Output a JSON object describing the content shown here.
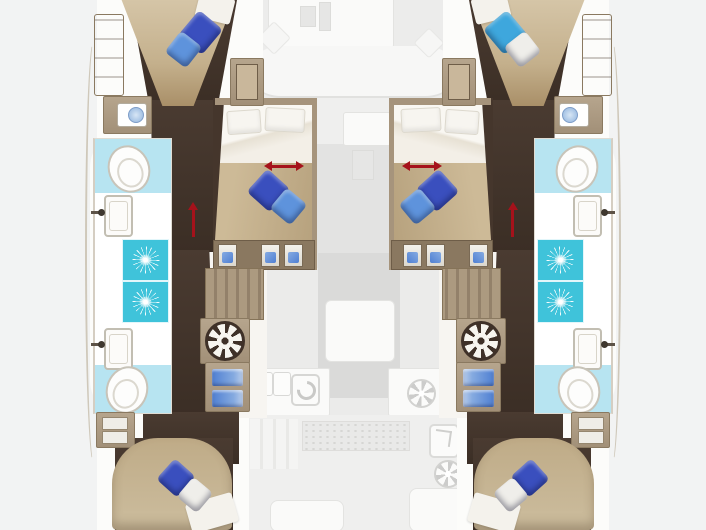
{
  "diagram": {
    "type": "yacht-floor-plan",
    "subject": "catamaran lower deck layout with faded upper-deck overlay",
    "background": "#f2f3f3"
  },
  "palette": {
    "hull_wood_dark": "#42342b",
    "cabinet_tan": "#ab9a82",
    "bed_tan": "#c8b593",
    "bedding_white": "#f6f4ef",
    "shower_teal": "#3fc3da",
    "bath_floor_blue": "#b7e4f1",
    "fixture_white": "#fdfdfc",
    "arrow_red": "#a5121b",
    "drawer_blue": "#4f7fd2",
    "faded_deck_gray": "#e6e6e5"
  },
  "cabins": {
    "port_bow": {
      "label": "port bow cabin",
      "pillow_colors": [
        "#3a4fbe",
        "#5e93dc"
      ]
    },
    "port_mid": {
      "label": "port middle cabin",
      "pillow_colors": [
        "#3a4fbe",
        "#5e93dc"
      ],
      "has_slide_arrow": true
    },
    "port_aft": {
      "label": "port aft cabin",
      "pillow_colors": [
        "#3a4fbe",
        "#efeeea"
      ]
    },
    "stbd_bow": {
      "label": "starboard bow cabin",
      "pillow_colors": [
        "#3ea7dd",
        "#efeeea"
      ]
    },
    "stbd_mid": {
      "label": "starboard middle cabin",
      "pillow_colors": [
        "#3a4fbe",
        "#5e93dc"
      ],
      "has_slide_arrow": true
    },
    "stbd_aft": {
      "label": "starboard aft cabin",
      "pillow_colors": [
        "#3a4fbe",
        "#efeeea"
      ]
    }
  },
  "hulls": {
    "port": {
      "bathrooms": 2,
      "showers": 2,
      "toilets": 2,
      "sinks": 2,
      "vanity": 1,
      "washing_machine": 1,
      "stairs": 1,
      "entry_arrow": 1
    },
    "starboard": {
      "bathrooms": 2,
      "showers": 2,
      "toilets": 2,
      "sinks": 2,
      "vanity": 1,
      "washing_machine": 1,
      "stairs": 1,
      "entry_arrow": 1
    }
  },
  "center_deck": {
    "areas": [
      "foredeck seating",
      "saloon",
      "galley with sink and stove",
      "cockpit with grating and tables"
    ],
    "rendering": "faded gray overlay"
  },
  "annotations": {
    "bed_slide_arrows": 2,
    "corridor_entry_arrows": 2,
    "arrow_color": "#a5121b"
  }
}
